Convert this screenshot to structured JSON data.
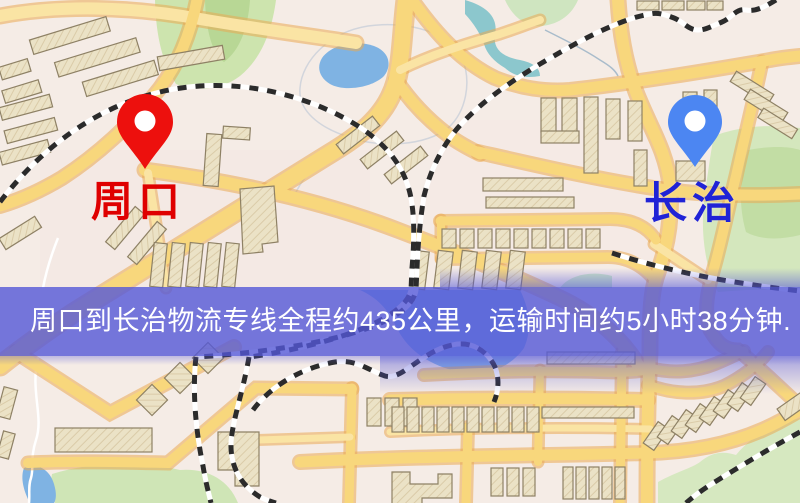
{
  "screen": {
    "width_px": 800,
    "height_px": 503,
    "kind": "route-map-screenshot"
  },
  "markers": {
    "origin": {
      "label": "周口",
      "pin_color": "#ed100d",
      "label_color": "#df0000"
    },
    "destination": {
      "label": "长治",
      "pin_color": "#4c86f2",
      "label_color": "#2023d6"
    }
  },
  "banner": {
    "text": "周口到长治物流专线全程约435公里，运输时间约5小时38分钟.",
    "background_color": "#5457d7",
    "text_color": "#ffffff",
    "distance_text": "435公里",
    "duration_text": "5小时38分钟"
  },
  "map_palette": {
    "background": "#f5ece6",
    "road_fill": "#f8d77c",
    "road_casing": "#eaaa52",
    "building_fill": "#ebe2c6",
    "park_green": "#cde4ae",
    "water_blue": "#7fb3e3",
    "stream_teal": "#8cc7cd",
    "railway_black": "#2b2b2b"
  }
}
